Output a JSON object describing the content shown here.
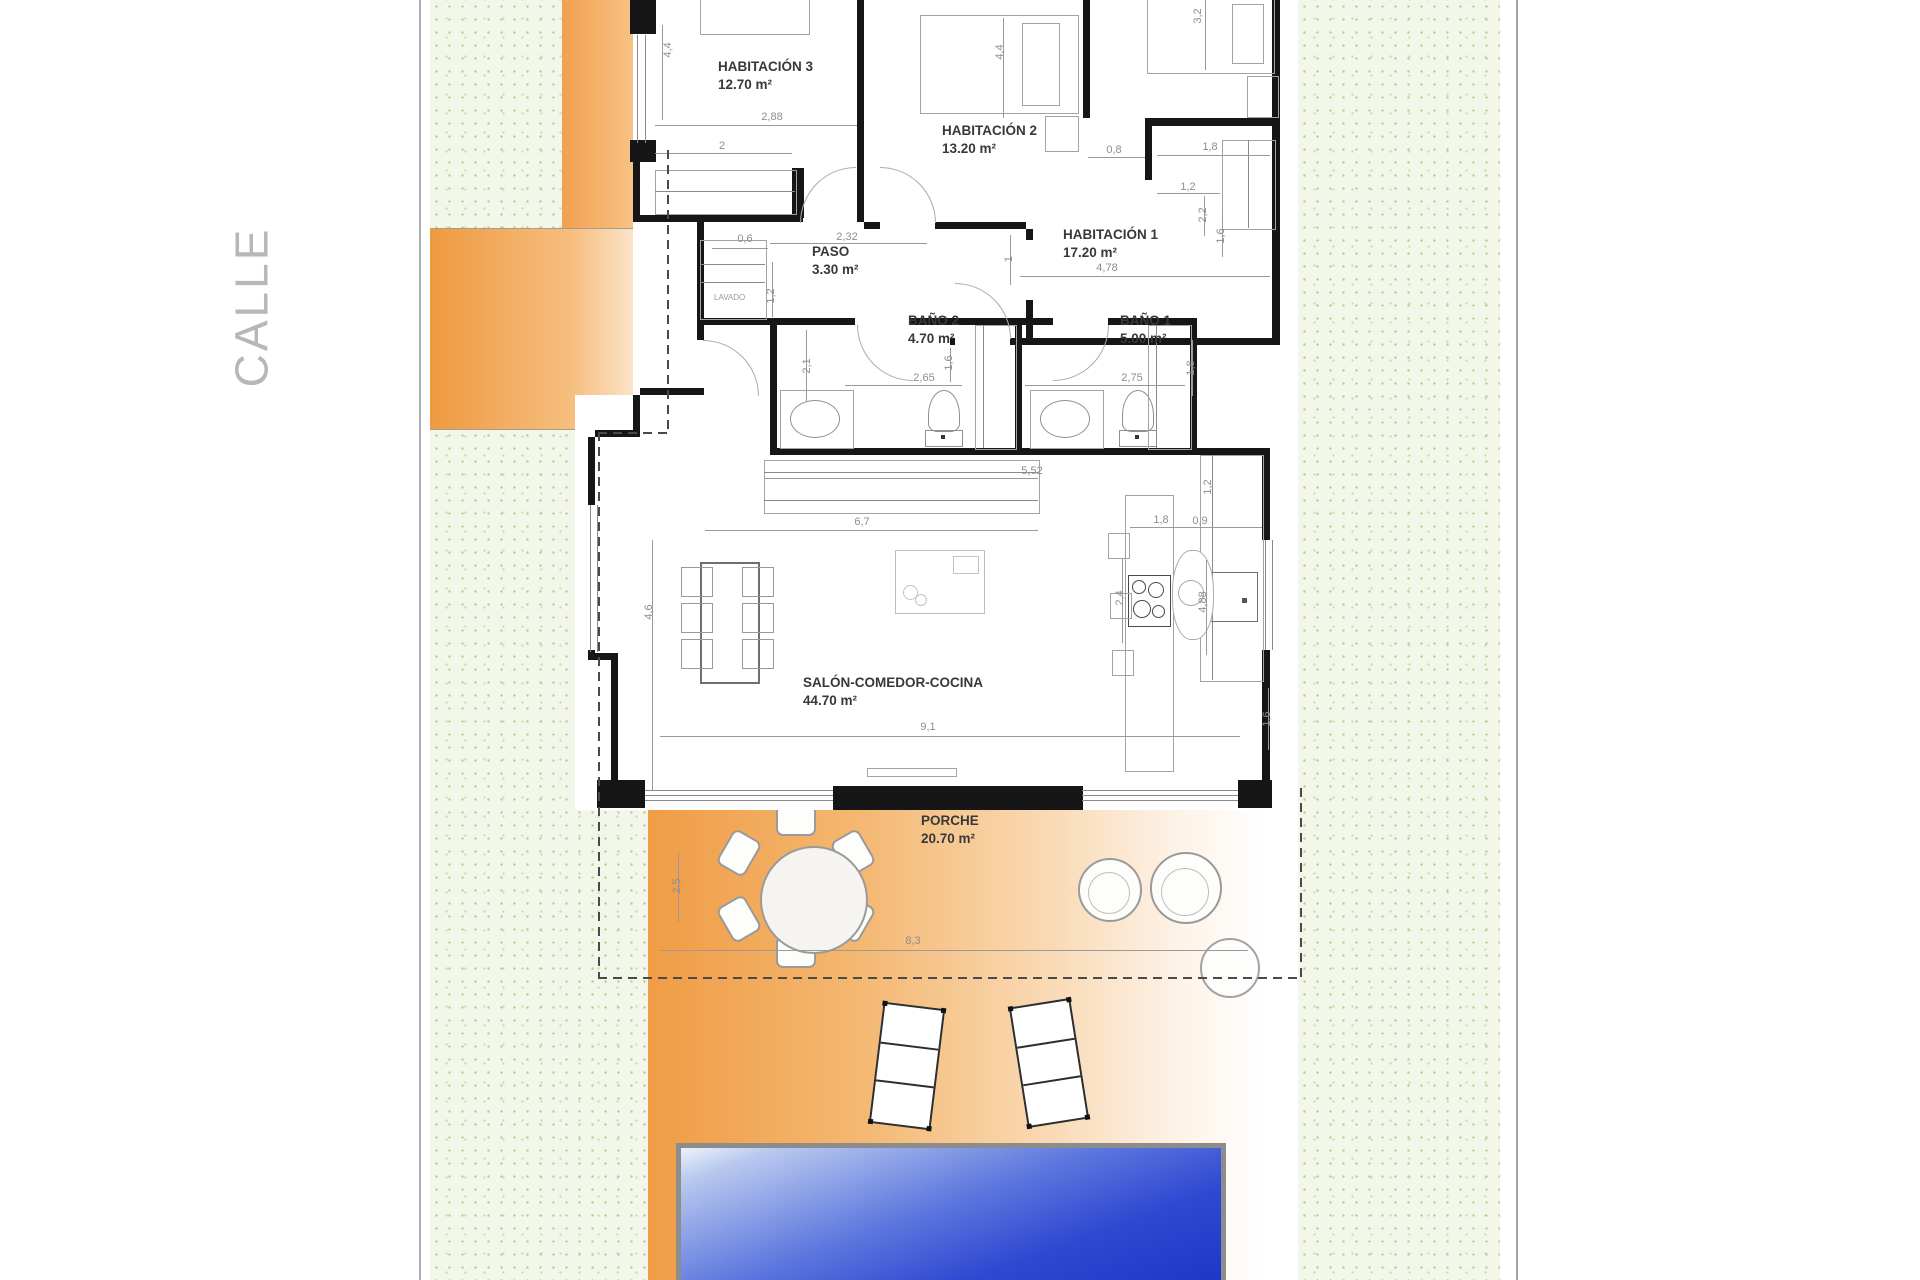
{
  "plan": {
    "street_label": "CALLE",
    "closet_label": "LAVADO",
    "rooms": [
      {
        "id": "habitacion-3",
        "name": "HABITACIÓN 3",
        "area": "12.70 m²",
        "x": 718,
        "y": 58
      },
      {
        "id": "habitacion-2",
        "name": "HABITACIÓN 2",
        "area": "13.20 m²",
        "x": 942,
        "y": 122
      },
      {
        "id": "habitacion-1",
        "name": "HABITACIÓN 1",
        "area": "17.20 m²",
        "x": 1063,
        "y": 226
      },
      {
        "id": "paso",
        "name": "PASO",
        "area": "3.30 m²",
        "x": 812,
        "y": 243
      },
      {
        "id": "bano-2",
        "name": "BAÑO 2",
        "area": "4.70 m²",
        "x": 908,
        "y": 312
      },
      {
        "id": "bano-1",
        "name": "BAÑO 1",
        "area": "5.00 m²",
        "x": 1120,
        "y": 312
      },
      {
        "id": "salon-comedor-cocina",
        "name": "SALÓN-COMEDOR-COCINA",
        "area": "44.70 m²",
        "x": 803,
        "y": 674
      },
      {
        "id": "porche",
        "name": "PORCHE",
        "area": "20.70 m²",
        "x": 921,
        "y": 812
      }
    ],
    "dimensions": [
      {
        "text": "4,4",
        "x": 668,
        "y": 50,
        "rot": -90
      },
      {
        "text": "2,88",
        "x": 772,
        "y": 117,
        "rot": 0
      },
      {
        "text": "2",
        "x": 722,
        "y": 146,
        "rot": 0
      },
      {
        "text": "4,4",
        "x": 1000,
        "y": 52,
        "rot": -90
      },
      {
        "text": "3,2",
        "x": 1198,
        "y": 16,
        "rot": -90
      },
      {
        "text": "0,8",
        "x": 1114,
        "y": 150,
        "rot": 0
      },
      {
        "text": "1,8",
        "x": 1210,
        "y": 147,
        "rot": 0
      },
      {
        "text": "1,2",
        "x": 1188,
        "y": 187,
        "rot": 0
      },
      {
        "text": "2,2",
        "x": 1203,
        "y": 215,
        "rot": -90
      },
      {
        "text": "1,6",
        "x": 1221,
        "y": 236,
        "rot": -90
      },
      {
        "text": "4,78",
        "x": 1107,
        "y": 268,
        "rot": 0
      },
      {
        "text": "1",
        "x": 1009,
        "y": 259,
        "rot": -90
      },
      {
        "text": "0,6",
        "x": 745,
        "y": 239,
        "rot": 0
      },
      {
        "text": "2,32",
        "x": 847,
        "y": 237,
        "rot": 0
      },
      {
        "text": "1,2",
        "x": 771,
        "y": 296,
        "rot": -90
      },
      {
        "text": "2,65",
        "x": 924,
        "y": 378,
        "rot": 0
      },
      {
        "text": "1,6",
        "x": 949,
        "y": 363,
        "rot": -90
      },
      {
        "text": "2,1",
        "x": 807,
        "y": 366,
        "rot": -90
      },
      {
        "text": "2,75",
        "x": 1132,
        "y": 378,
        "rot": 0
      },
      {
        "text": "1,8",
        "x": 1191,
        "y": 368,
        "rot": -90
      },
      {
        "text": "5,52",
        "x": 1032,
        "y": 471,
        "rot": 0
      },
      {
        "text": "6,7",
        "x": 862,
        "y": 522,
        "rot": 0
      },
      {
        "text": "1,8",
        "x": 1161,
        "y": 520,
        "rot": 0
      },
      {
        "text": "0,9",
        "x": 1200,
        "y": 521,
        "rot": 0
      },
      {
        "text": "1,2",
        "x": 1208,
        "y": 487,
        "rot": -90
      },
      {
        "text": "4,6",
        "x": 649,
        "y": 612,
        "rot": -90
      },
      {
        "text": "2,4",
        "x": 1120,
        "y": 598,
        "rot": -90
      },
      {
        "text": "4,88",
        "x": 1203,
        "y": 602,
        "rot": -90
      },
      {
        "text": "9,1",
        "x": 928,
        "y": 727,
        "rot": 0
      },
      {
        "text": "1,6",
        "x": 1267,
        "y": 719,
        "rot": -90
      },
      {
        "text": "8,3",
        "x": 913,
        "y": 941,
        "rot": 0
      },
      {
        "text": "2,5",
        "x": 677,
        "y": 886,
        "rot": -90
      }
    ],
    "colors": {
      "garden_green": "#f3f7e9",
      "garden_dot": "#b9c98f",
      "driveway_orange": "#f09c45",
      "pool_blue_deep": "#1e35c6",
      "pool_blue_light": "#eef3fb",
      "wall_black": "#161616",
      "dimension_gray": "#8d8d8d",
      "street_gray": "#b7b7b7"
    }
  }
}
